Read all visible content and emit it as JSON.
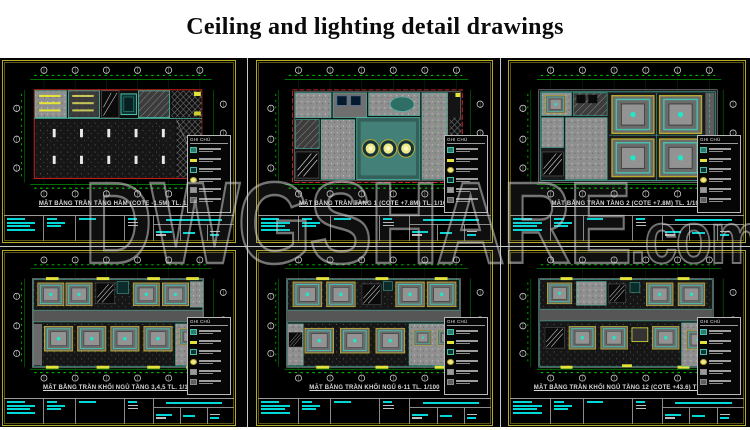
{
  "page": {
    "title": "Ceiling and lighting detail drawings"
  },
  "watermark": {
    "text": "DWGSHARE",
    "suffix": ".com"
  },
  "legend": {
    "title": "GHI CHÚ"
  },
  "colors": {
    "sheet_border_yellow": "#b5aa28",
    "dimension_green": "#00b400",
    "annotation_cyan": "#00d8d8",
    "plan_outline_red": "#cc2222",
    "ceiling_teal": "#49bfa9",
    "light_fixture_yellow": "#e3e33a",
    "coffer_frame_olive": "#b8a830",
    "fill_gray": "#8f8f8f"
  },
  "panels": [
    {
      "caption": "MẶT BẰNG TRẦN TẦNG HẦM (COTE -1.5M) TL. 1/100"
    },
    {
      "caption": "MẶT BẰNG TRẦN TẦNG 1 (COTE +7.8M) TL. 1/100"
    },
    {
      "caption": "MẶT BẰNG TRẦN TẦNG 2 (COTE +7.8M) TL. 1/100"
    },
    {
      "caption": "MẶT BẰNG TRẦN KHỐI NGỦ TẦNG 3,4,5 TL. 1/100"
    },
    {
      "caption": "MẶT BẰNG TRẦN KHỐI NGỦ 6-11 TL. 1/100"
    },
    {
      "caption": "MẶT BẰNG TRẦN KHỐI NGỦ TẦNG 12 (COTE +43.6) TL. 1/100"
    }
  ]
}
